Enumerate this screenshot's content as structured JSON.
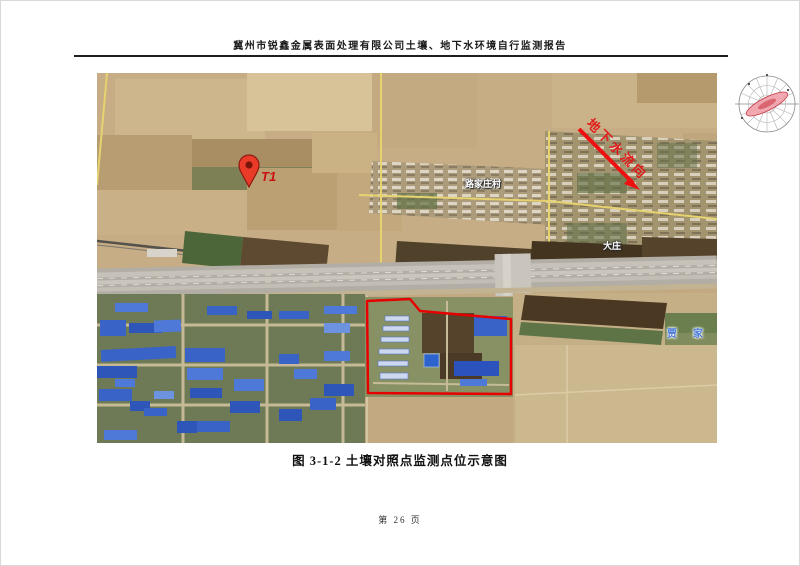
{
  "page": {
    "header_title": "冀州市锐鑫金属表面处理有限公司土壤、地下水环境自行监测报告",
    "figure_caption": "图 3-1-2 土壤对照点监测点位示意图",
    "page_number": "第 26 页"
  },
  "map": {
    "labels": {
      "monitoring_point": "T1",
      "groundwater_flow": "地下水流向",
      "village_center": "路家庄村",
      "village_right": "大庄",
      "blue_place_label": "贾家庄"
    },
    "colors": {
      "marker_red": "#ea3b28",
      "annotation_red": "#e01b1b",
      "boundary_red": "#e60000",
      "road_yellow": "#e6d370",
      "roof_blue": "#3a63c8",
      "blue_label": "#4a79d8"
    }
  }
}
